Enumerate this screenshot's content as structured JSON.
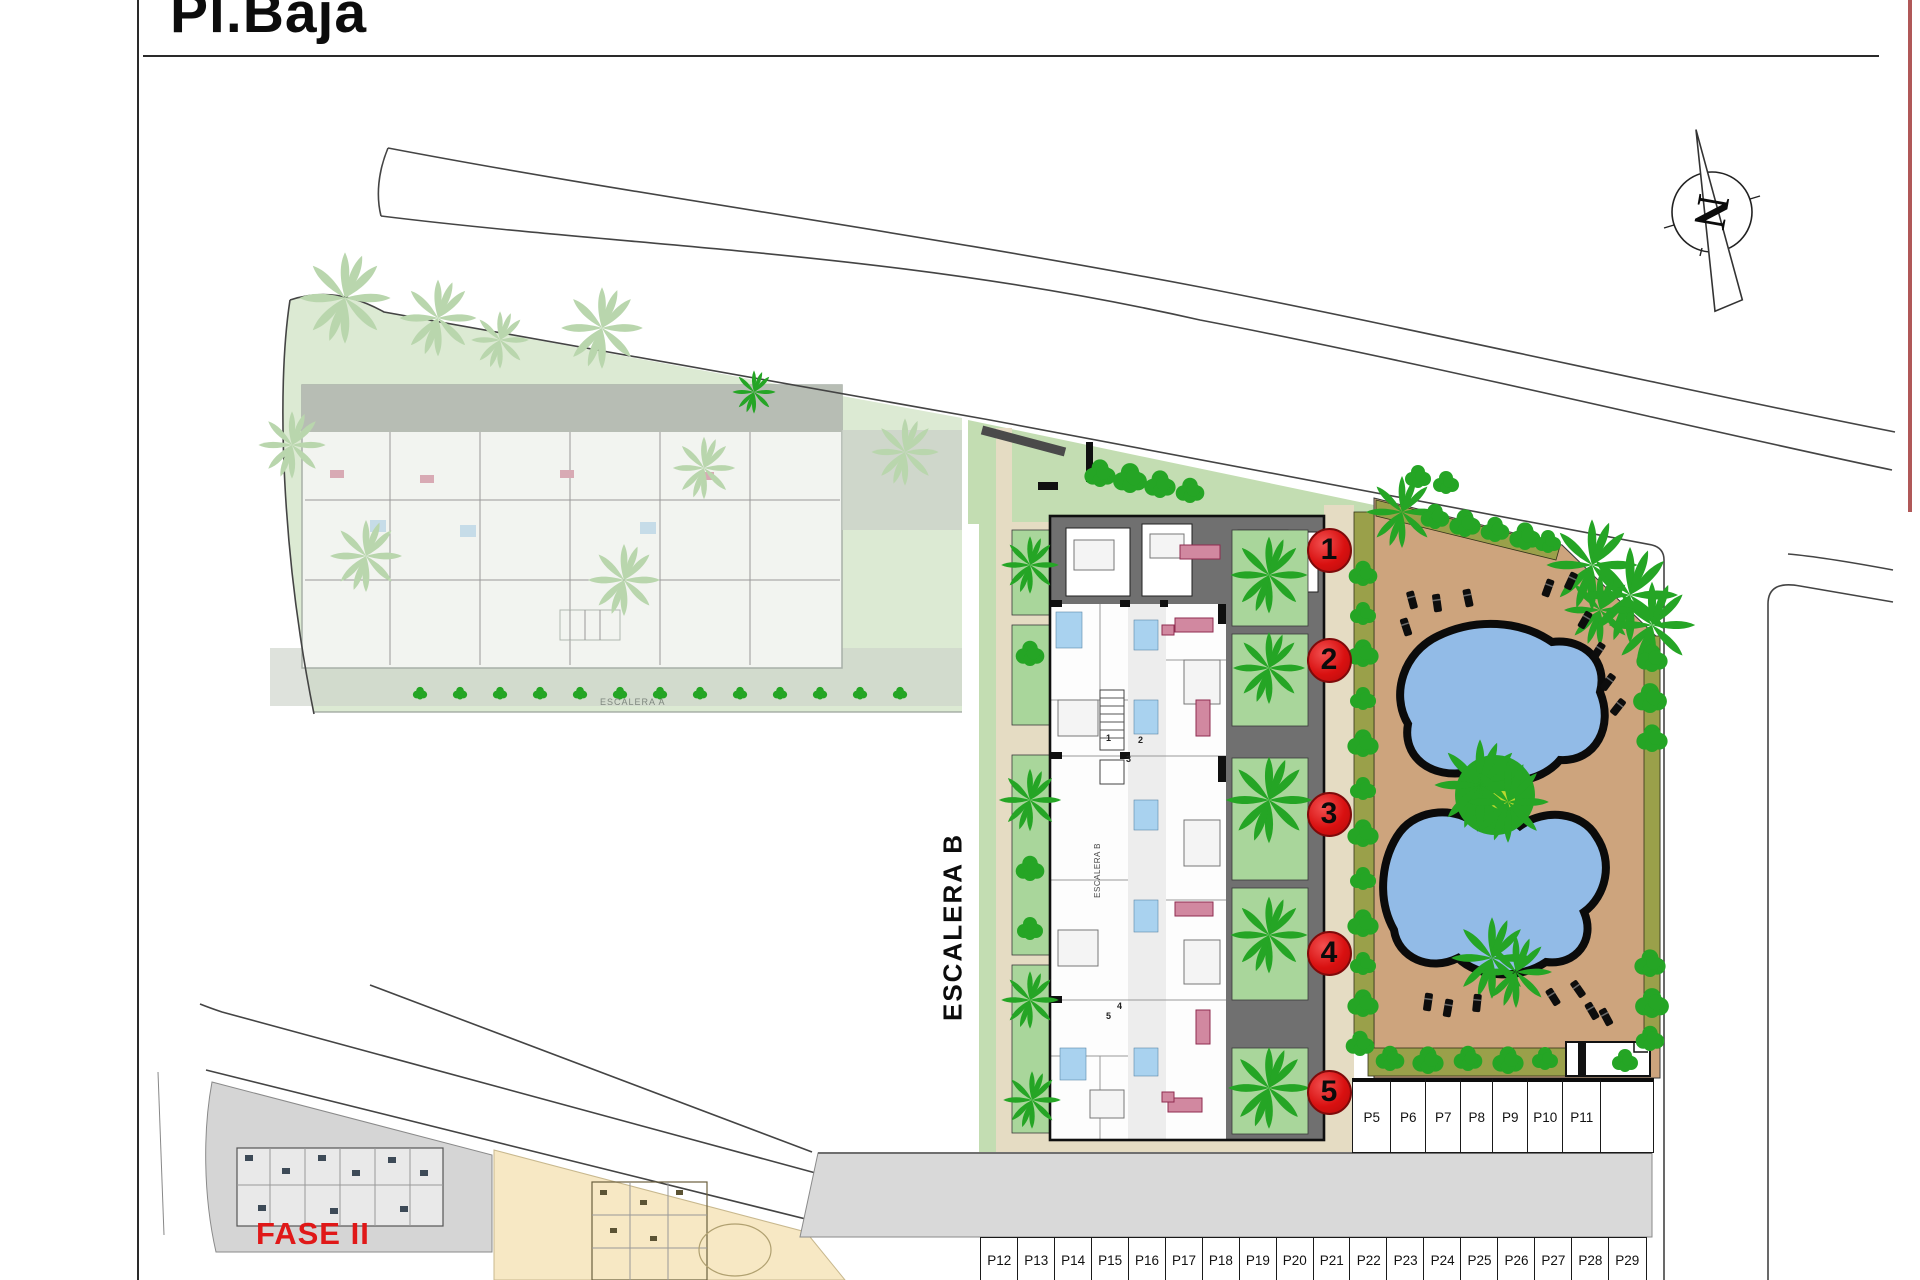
{
  "header": {
    "title": "Pl.Baja"
  },
  "labels": {
    "stairwell_b": "ESCALERA B",
    "stairwell_b_inner": "ESCALERA B",
    "stairwell_a_inner": "ESCALERA A",
    "phase2": "FASE II",
    "north": "N"
  },
  "unit_markers": [
    {
      "label": "1"
    },
    {
      "label": "2"
    },
    {
      "label": "3"
    },
    {
      "label": "4"
    },
    {
      "label": "5"
    }
  ],
  "plan_unit_numbers": [
    "1",
    "2",
    "3",
    "4",
    "5"
  ],
  "parking": {
    "side_row": [
      "P5",
      "P6",
      "P7",
      "P8",
      "P9",
      "P10",
      "P11"
    ],
    "bottom_row": [
      "P12",
      "P13",
      "P14",
      "P15",
      "P16",
      "P17",
      "P18",
      "P19",
      "P20",
      "P21",
      "P22",
      "P23",
      "P24",
      "P25",
      "P26",
      "P27",
      "P28",
      "P29"
    ]
  },
  "colors": {
    "accent_red": "#e31414",
    "phase_red": "#e01818",
    "terrace_tan": "#cda47d",
    "path_tan": "#e5dcc3",
    "pool_blue": "#92bbe7",
    "tree_green": "#25a525",
    "tree_accent": "#bcd92f",
    "patio_green": "#a9d69b",
    "wedge_green": "#c3ddb2",
    "hedge_olive": "#9aa04a",
    "faded_green": "#dcead3",
    "faded_gray": "#b7bdb4",
    "wall_gray": "#707070",
    "road_gray": "#d9d9d9",
    "bath_blue": "#a9d2ef",
    "sofa_pink": "#d188a0"
  }
}
